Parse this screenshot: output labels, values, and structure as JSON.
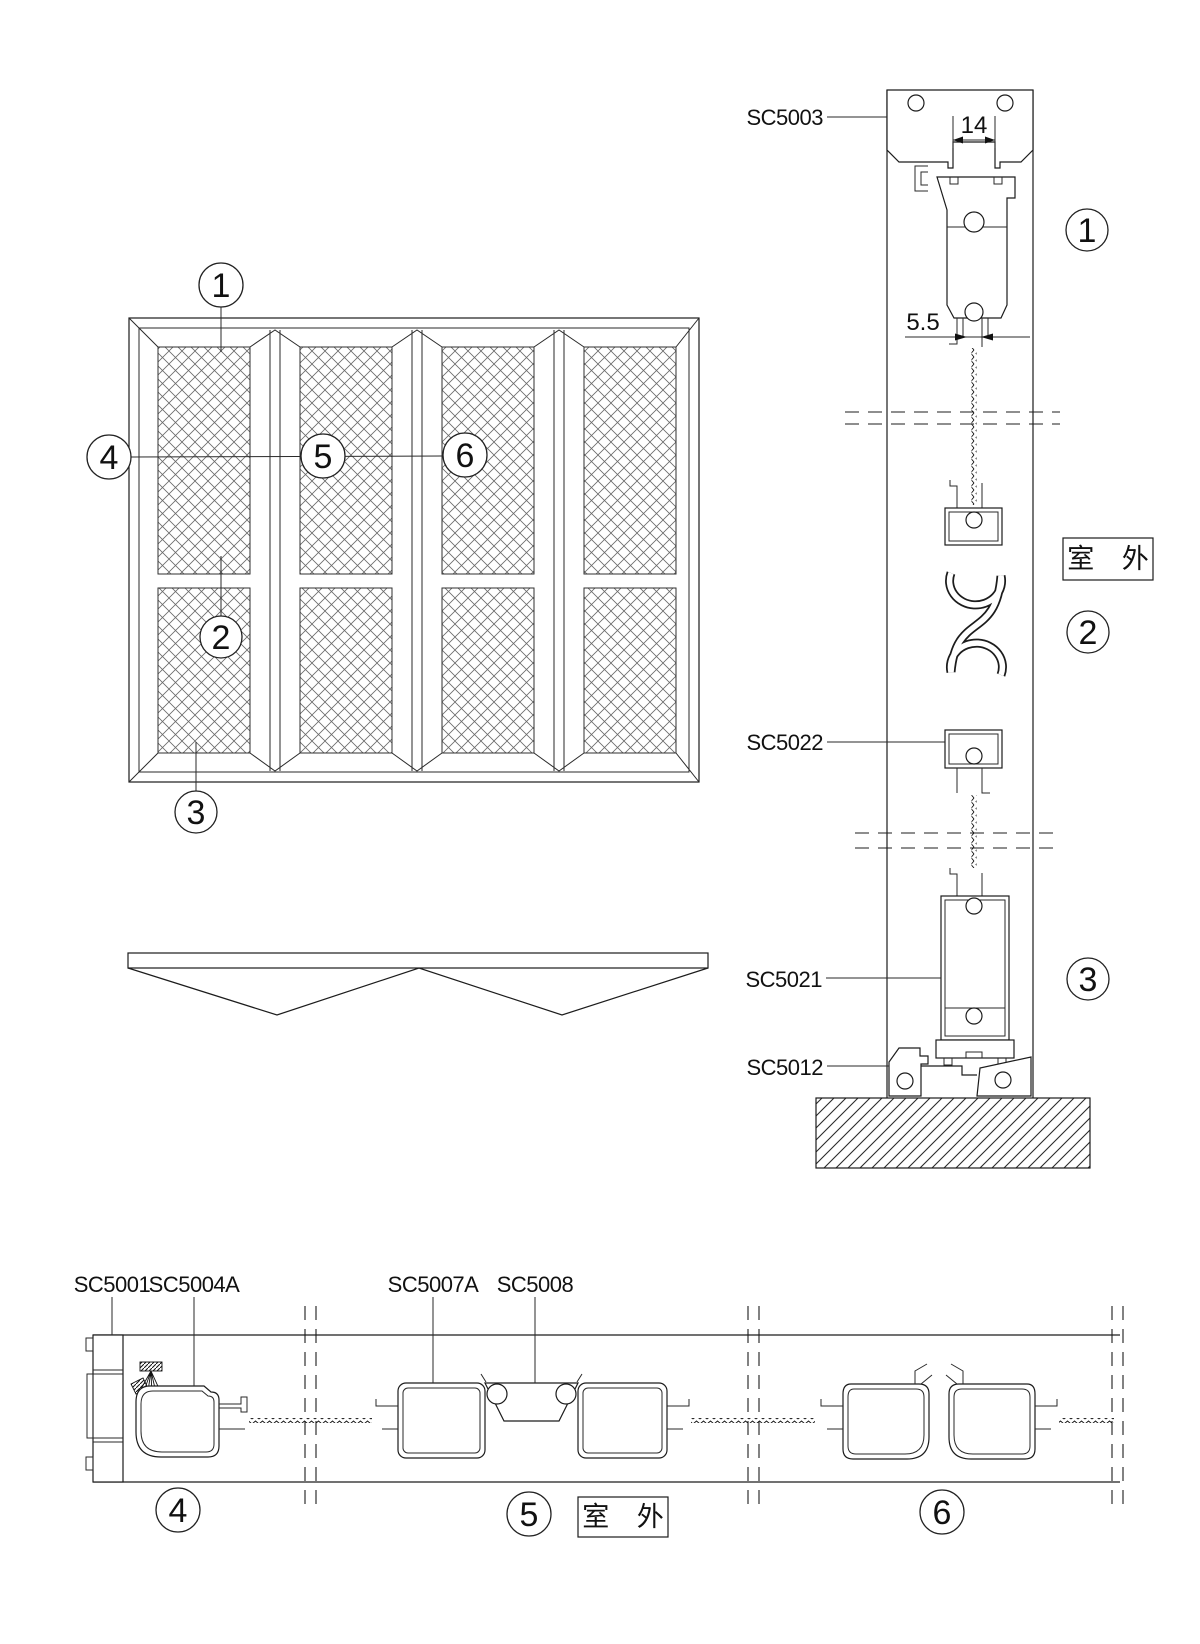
{
  "callouts": {
    "n1": "1",
    "n2": "2",
    "n3": "3",
    "n4": "4",
    "n5": "5",
    "n6": "6"
  },
  "vertical_section": {
    "labels": {
      "top_rail": "SC5003",
      "s_coupler": "SC5022",
      "bottom_rail": "SC5021",
      "sill": "SC5012"
    },
    "dims": {
      "slot_width": "14",
      "foot_gap": "5.5"
    },
    "outdoor_label": "室 外"
  },
  "horizontal_section": {
    "labels": {
      "jamb": "SC5001",
      "roller_stile": "SC5004A",
      "meeting_stile": "SC5007A",
      "coupler": "SC5008"
    },
    "outdoor_label": "室 外"
  }
}
